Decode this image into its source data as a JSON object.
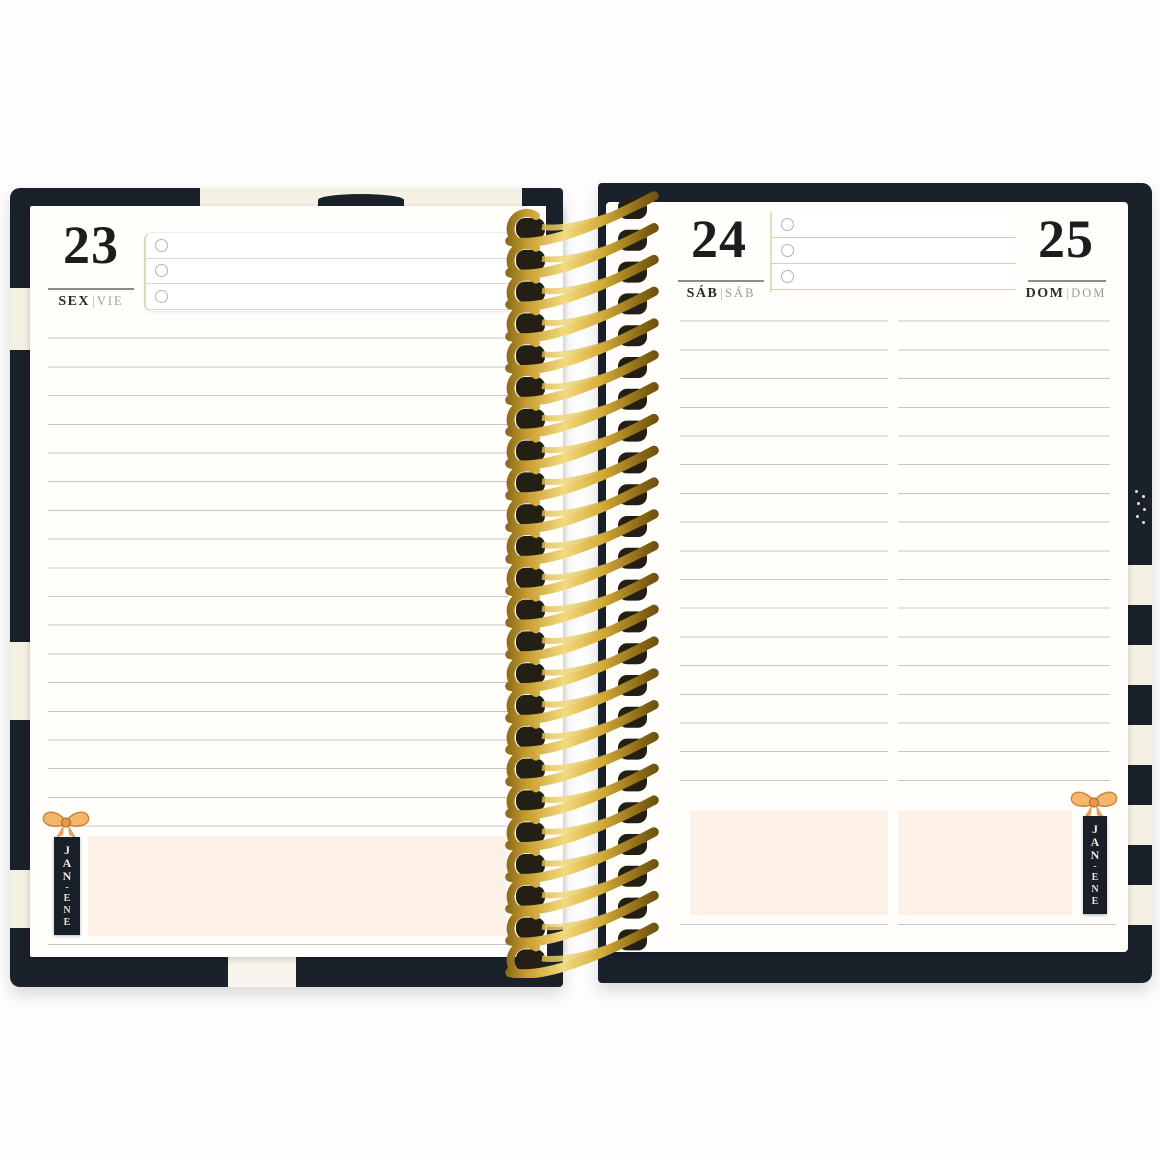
{
  "left_page": {
    "day_number": "23",
    "day_label_pt": "SEX",
    "day_label_separator": "|",
    "day_label_es": "VIE",
    "checklist_rows": 3,
    "month_tab": {
      "top": "JAN",
      "dash": "-",
      "bottom": "ENE"
    }
  },
  "right_page": {
    "col_left": {
      "day_number": "24",
      "day_label_pt": "SÁB",
      "day_label_separator": "|",
      "day_label_es": "SÁB"
    },
    "col_right": {
      "day_number": "25",
      "day_label_pt": "DOM",
      "day_label_separator": "|",
      "day_label_es": "DOM"
    },
    "checklist_rows": 3,
    "month_tab": {
      "top": "JAN",
      "dash": "-",
      "bottom": "ENE"
    }
  },
  "colors": {
    "cover_navy": "#1a212b",
    "cover_cream_stripe": "#f5f0e4",
    "highlight_pink": "#fdf0e7",
    "spiral_gold": "#c9a43a",
    "bow_orange": "#f3b66b",
    "ruled_line_gray": "#c6c6c4",
    "checklist_tan": "#e3d5b8"
  }
}
